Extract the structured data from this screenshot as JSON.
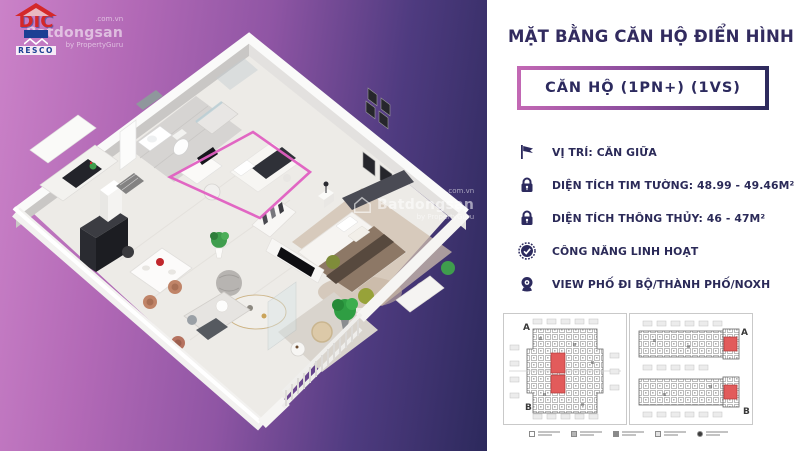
{
  "brand": {
    "logo_text": "DIC",
    "logo_sub": "RESCO"
  },
  "watermark": {
    "main": "Batdongsan",
    "suffix": ".com.vn",
    "by": "by PropertyGuru"
  },
  "panel": {
    "title": "MẶT BẰNG CĂN HỘ ĐIỂN HÌNH",
    "unit_badge": "CĂN HỘ (1PN+) (1VS)",
    "features": [
      {
        "icon": "flag-icon",
        "text": "VỊ TRÍ: CĂN GIỮA"
      },
      {
        "icon": "lock-icon",
        "text": "DIỆN TÍCH TIM TƯỜNG: 48.99 - 49.46M²"
      },
      {
        "icon": "lock-icon",
        "text": "DIỆN TÍCH THÔNG THỦY: 46 - 47M²"
      },
      {
        "icon": "check-badge-icon",
        "text": "CÔNG NĂNG LINH HOẠT"
      },
      {
        "icon": "webcam-icon",
        "text": "VIEW PHỐ ĐI BỘ/THÀNH PHỐ/NOXH"
      }
    ],
    "floorplates": {
      "left": {
        "label_top": "A",
        "label_bottom": "B"
      },
      "right": {
        "label_top": "A",
        "label_bottom": "B"
      }
    }
  },
  "colors": {
    "accent_pink": "#e05fc1",
    "navy": "#2c2a5e",
    "highlight_red": "#e25b5b",
    "gradient_left": "#cb82c8",
    "gradient_right": "#2c295c",
    "logo_red": "#d4282a",
    "logo_blue": "#1b3f94"
  }
}
